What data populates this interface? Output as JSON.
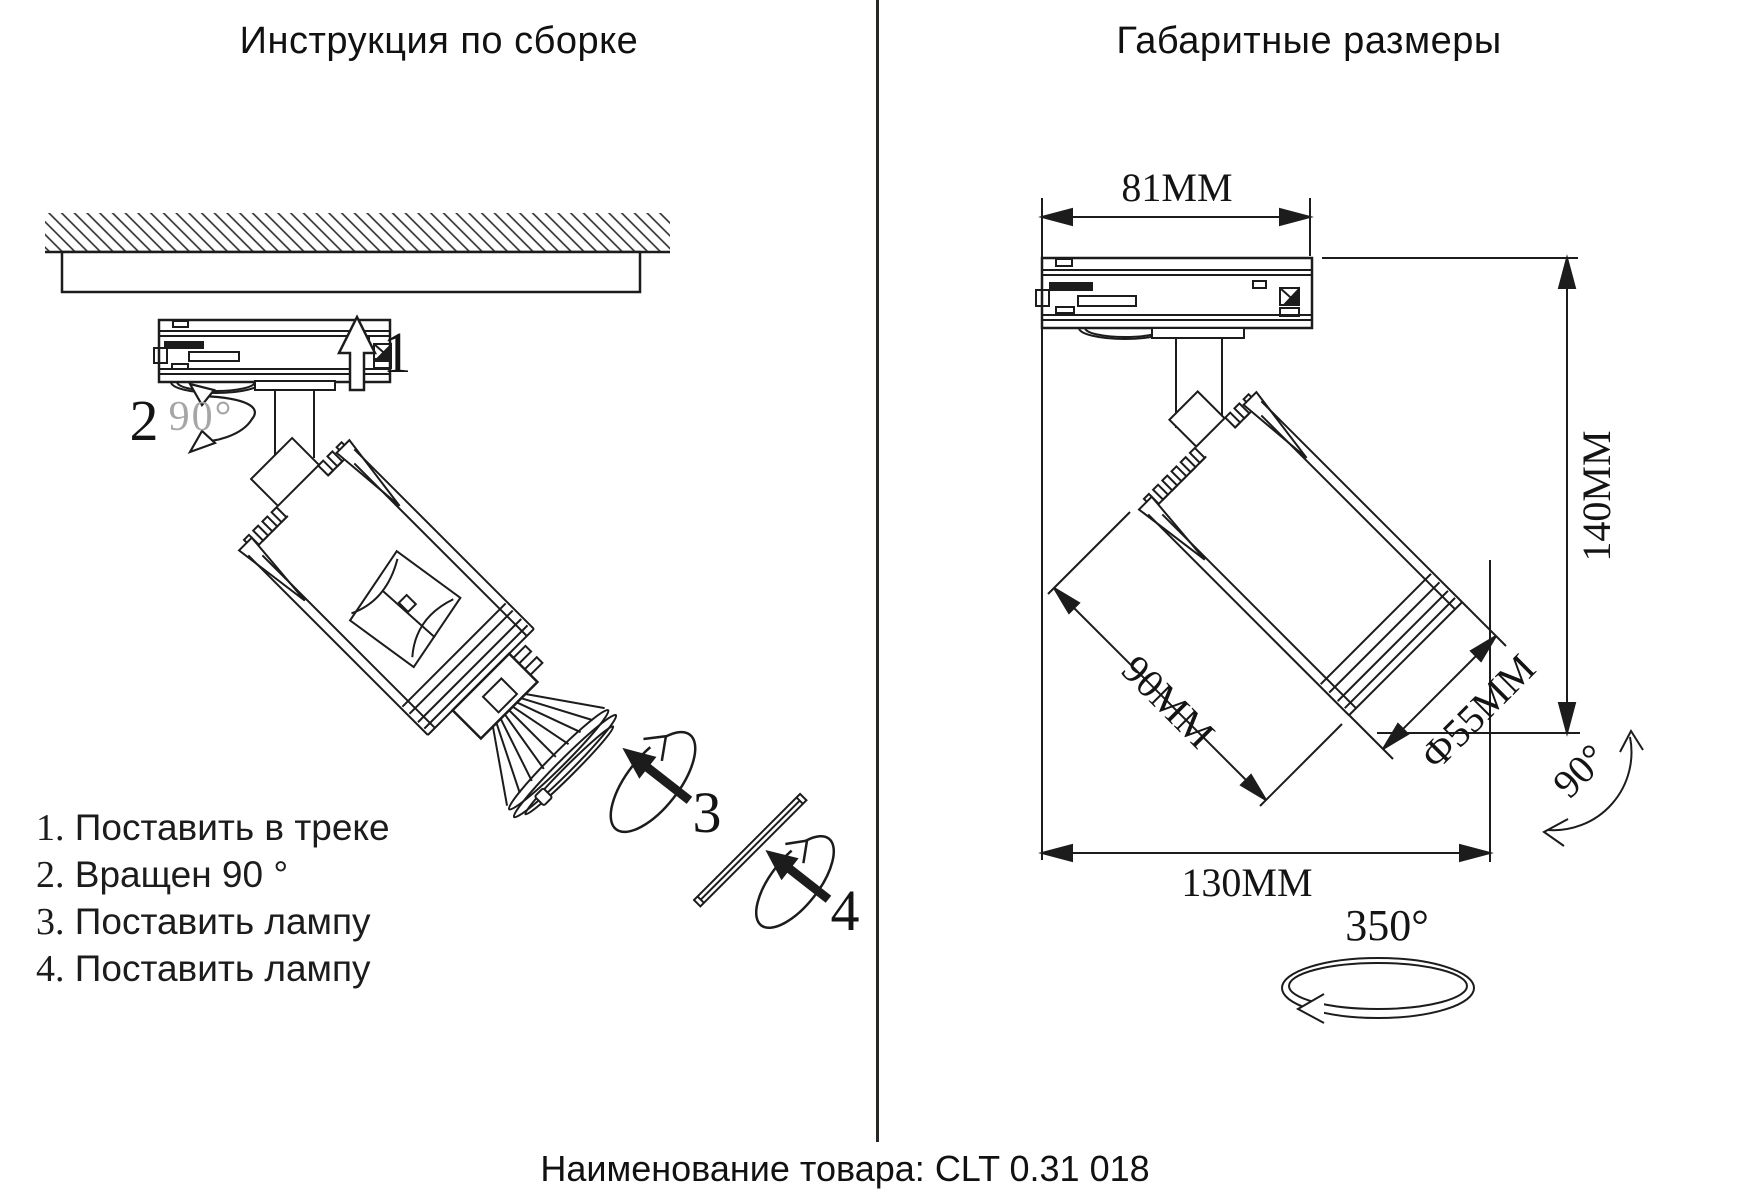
{
  "left_panel": {
    "title": "Инструкция по сборке",
    "steps": [
      {
        "num": "1.",
        "text": "Поставить в треке"
      },
      {
        "num": "2.",
        "text": "Вращен 90 °"
      },
      {
        "num": "3.",
        "text": "Поставить лампу"
      },
      {
        "num": "4.",
        "text": "Поставить лампу"
      }
    ],
    "markers": {
      "step1": "1",
      "step2": "2",
      "step3": "3",
      "step4": "4",
      "rotate_hint": "90°"
    }
  },
  "right_panel": {
    "title": "Габаритные размеры",
    "dimensions": {
      "adapter_width": "81MM",
      "total_height": "140MM",
      "body_length": "90MM",
      "body_diameter": "Ф55MM",
      "total_width": "130MM",
      "tilt_angle": "90°",
      "rotation_angle": "350°"
    }
  },
  "footer": {
    "product_label": "Наименование товара: CLT 0.31 018"
  },
  "colors": {
    "line": "#1c1c1c",
    "gray_hint": "#a6a6a6",
    "background": "#ffffff"
  }
}
